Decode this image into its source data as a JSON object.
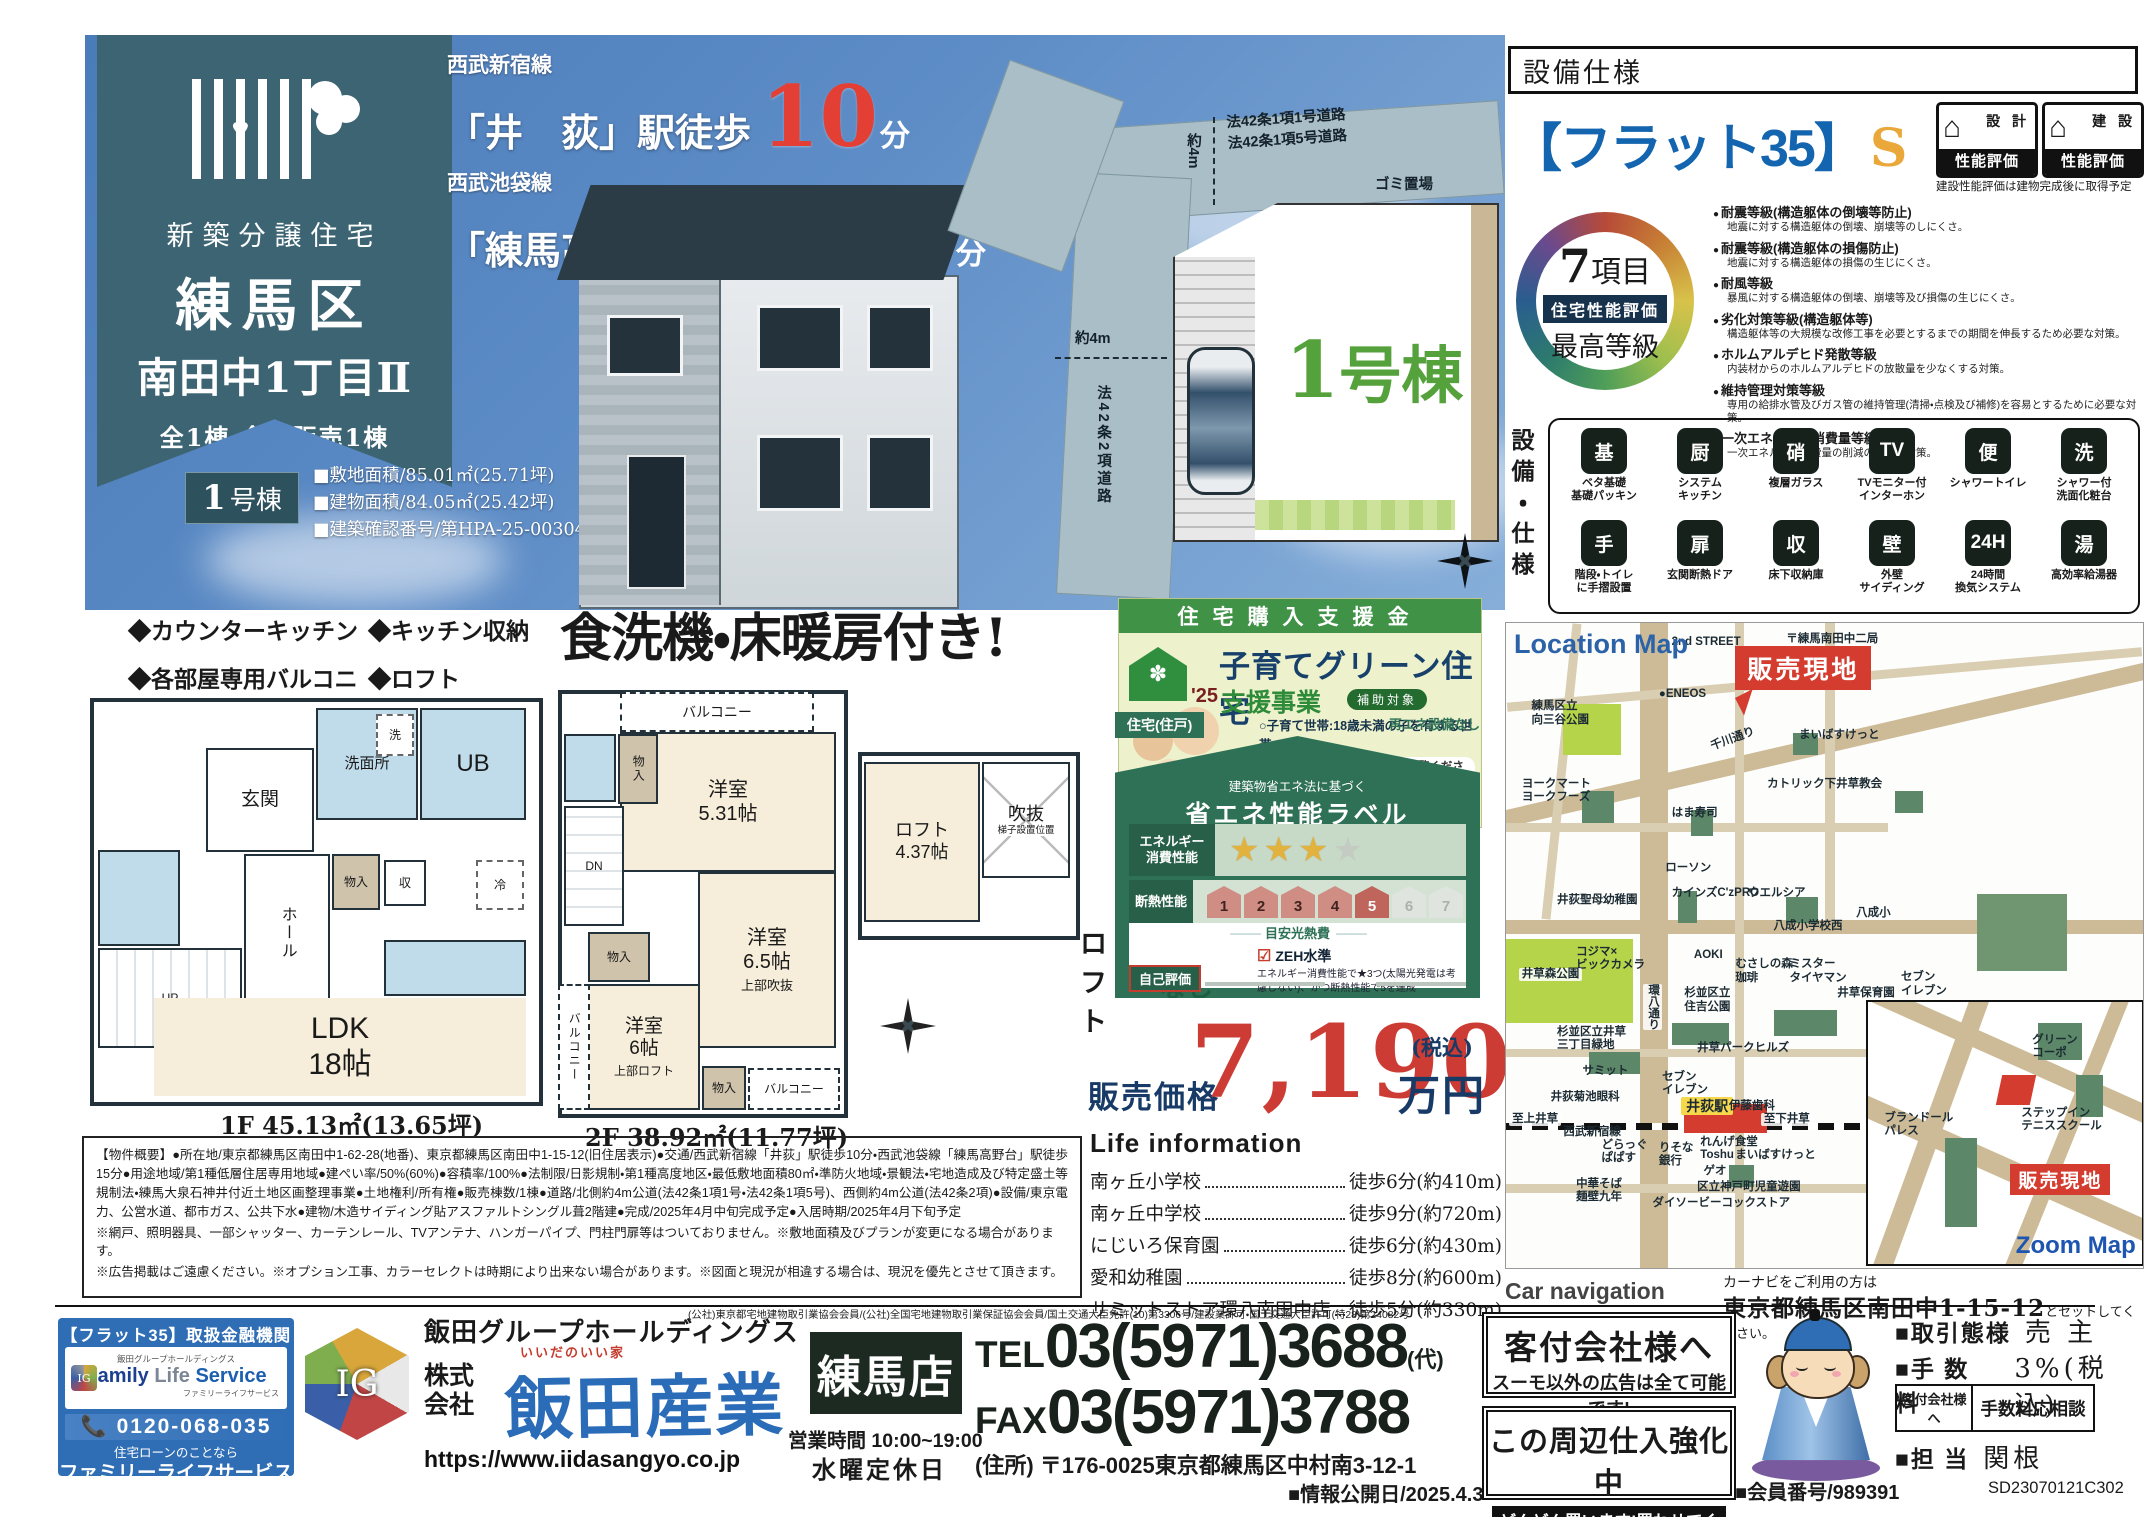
{
  "hero": {
    "banner": {
      "subtitle": "新築分譲住宅",
      "title_line1": "練馬区",
      "title_line2": "南田中1丁目Ⅱ",
      "note": "全1棟・今回販売1棟",
      "unit_no": "1",
      "unit_suffix": "号棟",
      "specs": [
        "■敷地面積/85.01㎡(25.71坪)",
        "■建物面積/84.05㎡(25.42坪)",
        "■建築確認番号/第HPA-25-00304-1号"
      ]
    },
    "access": [
      {
        "line": "西武新宿線",
        "station": "「井　荻」駅徒歩",
        "minutes": "10",
        "unit": "分"
      },
      {
        "line": "西武池袋線",
        "station": "「練馬高野台」駅徒歩",
        "minutes": "15",
        "unit": "分"
      }
    ],
    "siteplan": {
      "road_top": "法42条1項1号道路\n法42条1項5号道路",
      "trash": "ゴミ置場",
      "dim_v": "約4m",
      "dim_h": "約4m",
      "road_left": "法42条2項道路",
      "unit_no": "1",
      "unit_suffix": "号棟"
    }
  },
  "spec_panel": {
    "header": "設備仕様",
    "flat35": "【フラット35】",
    "flat35_s": "S",
    "badge1_house": "⌂",
    "badge1_top": "設 計",
    "badge1_bottom": "性能評価",
    "badge2_house": "⌂",
    "badge2_top": "建 設",
    "badge2_bottom": "性能評価",
    "badge_note": "建設性能評価は建物完成後に取得予定",
    "circle": {
      "num": "7",
      "items": "項目",
      "line2": "住宅性能評価",
      "line3": "最高等級"
    },
    "ratings": [
      {
        "title": "耐震等級(構造躯体の倒壊等防止)",
        "desc": "地震に対する構造躯体の倒壊、崩壊等のしにくさ。"
      },
      {
        "title": "耐震等級(構造躯体の損傷防止)",
        "desc": "地震に対する構造躯体の損傷の生じにくさ。"
      },
      {
        "title": "耐風等級",
        "desc": "暴風に対する構造躯体の倒壊、崩壊等及び損傷の生じにくさ。"
      },
      {
        "title": "劣化対策等級(構造躯体等)",
        "desc": "構造躯体等の大規模な改修工事を必要とするまでの期間を伸長するため必要な対策。"
      },
      {
        "title": "ホルムアルデヒド発散等級",
        "desc": "内装材からのホルムアルデヒドの放散量を少なくする対策。"
      },
      {
        "title": "維持管理対策等級",
        "desc": "専用の給排水管及びガス管の維持管理(清掃・点検及び補修)を容易とするために必要な対策。"
      },
      {
        "title": "一次エネルギー消費量等級",
        "desc": "一次エネルギー消費量の削減のための対策。"
      }
    ],
    "equipment_label": "設備・仕様",
    "equipment": [
      {
        "glyph": "基",
        "label": "ベタ基礎\n基礎パッキン"
      },
      {
        "glyph": "厨",
        "label": "システム\nキッチン"
      },
      {
        "glyph": "硝",
        "label": "複層ガラス"
      },
      {
        "glyph": "TV",
        "label": "TVモニター付\nインターホン"
      },
      {
        "glyph": "便",
        "label": "シャワートイレ"
      },
      {
        "glyph": "洗",
        "label": "シャワー付\n洗面化粧台"
      },
      {
        "glyph": "手",
        "label": "階段・トイレ\nに手摺設置"
      },
      {
        "glyph": "扉",
        "label": "玄関断熱ドア"
      },
      {
        "glyph": "収",
        "label": "床下収納庫"
      },
      {
        "glyph": "壁",
        "label": "外壁\nサイディング"
      },
      {
        "glyph": "24H",
        "label": "24時間\n換気システム"
      },
      {
        "glyph": "湯",
        "label": "高効率給湯器"
      }
    ]
  },
  "features": {
    "items": [
      "◆カウンターキッチン",
      "◆キッチン収納",
      "◆各部屋専用バルコニー",
      "◆ロフト"
    ]
  },
  "headline": "食洗機・床暖房付き!",
  "floorplans": {
    "genkan": "玄関",
    "senmenjo": "洗面所",
    "sen": "洗",
    "ub": "UB",
    "hall": "ホール",
    "up": "UP",
    "dn": "DN",
    "mono": "物入",
    "shu": "収",
    "rei": "冷",
    "ldk": "LDK\n18帖",
    "balcony": "バルコニー",
    "room531": "洋室\n5.31帖",
    "room65": "洋室\n6.5帖",
    "room65sub": "上部吹抜",
    "room6": "洋室\n6帖",
    "room6sub": "上部ロフト",
    "loft_room": "ロフト\n4.37帖",
    "void": "吹抜",
    "ladder": "梯子設置位置",
    "loft_caption": "ロフト",
    "area_1f": "1F 45.13㎡(13.65坪)",
    "area_2f": "2F 38.92㎡(11.77坪)"
  },
  "subsidy": {
    "header": "住宅購入支援金",
    "year": "'25",
    "house_mark": "✽",
    "title": "子育てグリーン住宅",
    "subtitle": "支援事業",
    "badge": "補助対象",
    "targets": "○子育て世帯:18歳未満の子を有する世帯\n○若者夫婦世帯:夫婦いずれかが39歳以下世帯",
    "notes": [
      "●詳しくは支援事業公式HP をご覧ください",
      "●物件により制度利用の可否がございます。\n詳細は担当営業にご確認ください。"
    ]
  },
  "energy": {
    "tab": "住宅(住戸)",
    "renewable": "再エネ設備なし",
    "law": "建築物省エネ法に基づく",
    "title": "省エネ性能ラベル",
    "row1_label": "エネルギー\n消費性能",
    "stars_gold": 3,
    "stars_total": 4,
    "row2_label": "断熱性能",
    "insulation_levels": 7,
    "insulation_achieved": 5,
    "cost_label": "目安光熱費",
    "cost_value": "なし",
    "zeh": "ZEH水準",
    "zeh_desc": "エネルギー消費性能で★3つ(太陽光発電は考慮しない)、かつ断熱性能で5を達成",
    "self_eval": "自己評価"
  },
  "price": {
    "label": "販売価格",
    "amount": "7,190",
    "tax": "(税込)",
    "unit": "万円"
  },
  "life_info": {
    "title": "Life information",
    "items": [
      {
        "name": "南ヶ丘小学校",
        "value": "徒歩6分(約410m)"
      },
      {
        "name": "南ヶ丘中学校",
        "value": "徒歩9分(約720m)"
      },
      {
        "name": "にじいろ保育園",
        "value": "徒歩6分(約430m)"
      },
      {
        "name": "愛和幼稚園",
        "value": "徒歩8分(約600m)"
      },
      {
        "name": "サミットストア環八南田中店",
        "value": "徒歩5分(約330m)"
      }
    ]
  },
  "map": {
    "title": "Location Map",
    "site_flag": "販売現地",
    "labels": [
      {
        "t": "2nd STREET",
        "x": 26,
        "y": 2
      },
      {
        "t": "〒練馬南田中二局",
        "x": 44,
        "y": 1.5
      },
      {
        "t": "●ENEOS",
        "x": 24,
        "y": 10
      },
      {
        "t": "練馬区立\n向三谷公園",
        "x": 4,
        "y": 12
      },
      {
        "t": "千川通り",
        "x": 32,
        "y": 17,
        "rot": -20
      },
      {
        "t": "まいばすけっと",
        "x": 46,
        "y": 16.5
      },
      {
        "t": "ヨークマート\nヨークフーズ",
        "x": 2.5,
        "y": 24
      },
      {
        "t": "カトリック下井草教会",
        "x": 41,
        "y": 24
      },
      {
        "t": "はま寿司",
        "x": 26,
        "y": 28.5
      },
      {
        "t": "ローソン",
        "x": 25,
        "y": 37
      },
      {
        "t": "井荻聖母幼稚園",
        "x": 8,
        "y": 42
      },
      {
        "t": "カインズC'zPRO",
        "x": 26,
        "y": 41
      },
      {
        "t": "ウエルシア",
        "x": 38,
        "y": 41
      },
      {
        "t": "八成小",
        "x": 54.5,
        "y": 44,
        "cls": "white"
      },
      {
        "t": "八成小学校西",
        "x": 42,
        "y": 46
      },
      {
        "t": "コジマ×\nビックカメラ",
        "x": 11,
        "y": 50
      },
      {
        "t": "AOKI",
        "x": 29.5,
        "y": 50.5
      },
      {
        "t": "井草森公園",
        "x": 2,
        "y": 53.5,
        "cls": "white"
      },
      {
        "t": "むさしの森\n珈琲",
        "x": 36,
        "y": 52
      },
      {
        "t": "ミスター\nタイヤマン",
        "x": 44.5,
        "y": 52
      },
      {
        "t": "井草保育園",
        "x": 52,
        "y": 56.5
      },
      {
        "t": "セブン\nイレブン",
        "x": 62,
        "y": 54
      },
      {
        "t": "環八通り",
        "x": 21.5,
        "y": 56,
        "cls": "vert white"
      },
      {
        "t": "杉並区立\n住吉公園",
        "x": 28,
        "y": 56.5
      },
      {
        "t": "杉並区立井草\n三丁目緑地",
        "x": 8,
        "y": 62.5
      },
      {
        "t": "井草パークヒルズ",
        "x": 30,
        "y": 65
      },
      {
        "t": "サミット",
        "x": 12,
        "y": 68.5
      },
      {
        "t": "セブン\nイレブン",
        "x": 24.5,
        "y": 69.5
      },
      {
        "t": "井荻菊池眼科",
        "x": 7,
        "y": 72.5
      },
      {
        "t": "井荻駅",
        "x": 27.5,
        "y": 73.5,
        "cls": "station"
      },
      {
        "t": "伊藤歯科",
        "x": 35,
        "y": 74
      },
      {
        "t": "至上井草",
        "x": 0.5,
        "y": 76,
        "cls": "white"
      },
      {
        "t": "西武新宿線",
        "x": 9,
        "y": 78
      },
      {
        "t": "至下井草",
        "x": 40,
        "y": 76,
        "cls": "white"
      },
      {
        "t": "どらっぐ\nぱぱす",
        "x": 15,
        "y": 80
      },
      {
        "t": "りそな\n銀行",
        "x": 24,
        "y": 80.5
      },
      {
        "t": "れんげ食堂\nToshu",
        "x": 30.5,
        "y": 79.5
      },
      {
        "t": "まいばすけっと",
        "x": 36,
        "y": 81.5
      },
      {
        "t": "ゲオ",
        "x": 31,
        "y": 84
      },
      {
        "t": "区立神戸町児童遊園",
        "x": 30,
        "y": 86.5
      },
      {
        "t": "中華そば\n麺壁九年",
        "x": 11,
        "y": 86
      },
      {
        "t": "ダイソービーコックストア",
        "x": 23,
        "y": 89
      }
    ],
    "zoom_inset": {
      "title": "Zoom Map",
      "site_flag": "販売現地",
      "labels": [
        {
          "t": "グリーン\nコーポ",
          "x": 60,
          "y": 12
        },
        {
          "t": "ステップイン\nテニススクール",
          "x": 56,
          "y": 40
        },
        {
          "t": "ブランドール\nパレス",
          "x": 6,
          "y": 42
        }
      ]
    },
    "car_nav_label": "Car navigation",
    "car_nav_line1": "カーナビをご利用の方は",
    "car_nav_addr": "東京都練馬区南田中1-15-12",
    "car_nav_line2_suffix": "とセットしてください。"
  },
  "outline": {
    "main": "【物件概要】●所在地/東京都練馬区南田中1-62-28(地番)、東京都練馬区南田中1-15-12(旧住居表示)●交通/西武新宿線「井荻」駅徒歩10分・西武池袋線「練馬高野台」駅徒歩15分●用途地域/第1種低層住居専用地域●建ぺい率/50%(60%)●容積率/100%●法制限/日影規制・第1種高度地区・最低敷地面積80㎡・準防火地域・景観法・宅地造成及び特定盛土等規制法・練馬大泉石神井付近土地区画整理事業●土地権利/所有権●販売棟数/1棟●道路/北側約4m公道(法42条1項1号・法42条1項5号)、西側約4m公道(法42条2項)●設備/東京電力、公営水道、都市ガス、公共下水●建物/木造サイディング貼アスファルトシングル葺2階建●完成/2025年4月中旬完成予定●入居時期/2025年4月下旬予定",
    "note1": "※網戸、照明器具、一部シャッター、カーテンレール、TVアンテナ、ハンガーパイプ、門柱門扉等はついておりません。※敷地面積及びプランが変更になる場合があります。",
    "note2": "※広告掲載はご遠慮ください。※オプション工事、カラーセレクトは時期により出来ない場合があります。※図面と現況が相違する場合は、現況を優先とさせて頂きます。"
  },
  "footer": {
    "fls": {
      "header": "【フラット35】取扱金融機関",
      "cube": "IG",
      "group_small": "飯田グループホールディングス",
      "name_en_1": "Family",
      "name_en_2": "Life",
      "name_en_3": "Service",
      "name_kana_small": "ファミリーライフサービス",
      "phone": "📞 0120-068-035",
      "tagline": "住宅ローンのことなら",
      "name_kana": "ファミリーライフサービス"
    },
    "ig": "IG",
    "group_name": "飯田グループホールディングス",
    "license": "(公社)東京都宅地建物取引業協会会員/(公社)全国宅地建物取引業保証協会会員/国土交通大臣免許(10)第3306号/建設業許可・国土交通大臣許可(特28)第24082号",
    "kk": "株式\n会社",
    "company_ruby": "いいだのいい家",
    "company": "飯田産業",
    "url": "https://www.iidasangyo.co.jp",
    "branch": "練馬店",
    "hours": "営業時間 10:00~19:00",
    "holiday": "水曜定休日",
    "tel_label": "TEL",
    "tel": "03(5971)3688",
    "tel_suffix": "(代)",
    "fax_label": "FAX",
    "fax": "03(5971)3788",
    "address": "(住所) 〒176-0025東京都練馬区中村南3-12-1",
    "info_date": "■情報公開日/2025.4.3",
    "agent1_title": "客付会社様へ",
    "agent1_text": "スーモ以外の広告は全て可能です!",
    "agent2_line1": "この周辺仕入強化中",
    "agent2_line2": "どんどん買います!買わせてください。",
    "deal_label": "■取引態様",
    "deal_value": "売 主",
    "fee_label": "■手 数 料",
    "fee_value": "3%(税込)",
    "feetable_left": "客付会社様へ",
    "feetable_right": "手数料応相談",
    "staff_label": "■担 当",
    "staff_value": "関根",
    "member": "■会員番号/989391",
    "member_code": "SD23070121C302"
  }
}
